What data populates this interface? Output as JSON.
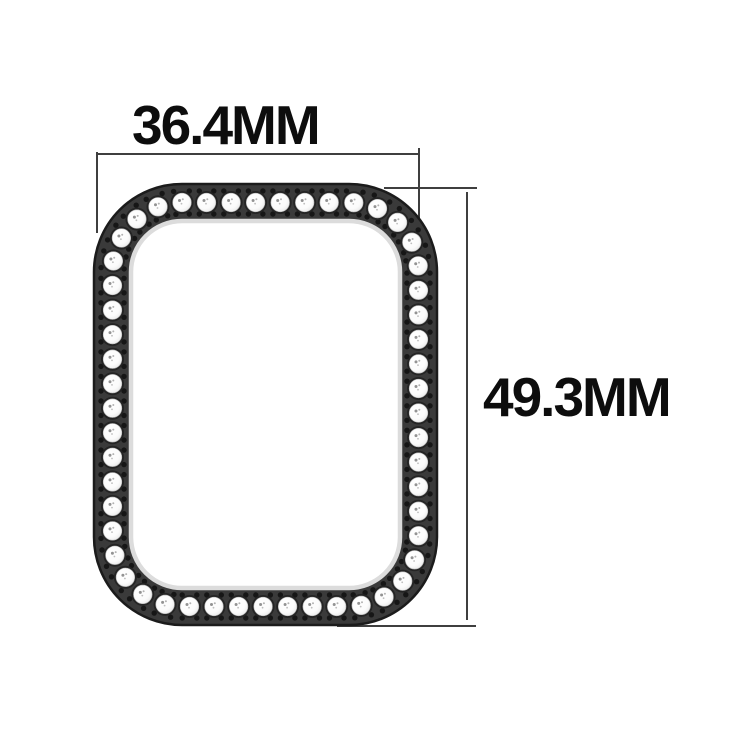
{
  "labels": {
    "width_label": "36.4MM",
    "height_label": "49.3MM"
  },
  "measurements": {
    "width_mm": 36.4,
    "height_mm": 49.3,
    "unit": "MM"
  },
  "colors": {
    "background": "#ffffff",
    "text": "#0d0d0d",
    "dimension_line": "#3f3f3f",
    "case_band": "#3a3a3a",
    "case_band_edge": "#1b1b1b",
    "inner_lip": "#dcdcdc",
    "stone_fill": "#ffffff",
    "stone_edge": "#b9b9b9",
    "stone_socket": "#242424",
    "stone_speck": "#808080",
    "prong_dot": "#161616"
  },
  "case_art": {
    "outer": {
      "x": 94,
      "y": 184,
      "width": 343,
      "height": 441,
      "radius": 88
    },
    "band_thickness": 37,
    "stone_count": 53,
    "stone_radius": 9.3,
    "dot_radius": 2.7,
    "dot_offset_perp": 11.5,
    "dot_offset_along": 5,
    "lip_width": 4.5
  }
}
